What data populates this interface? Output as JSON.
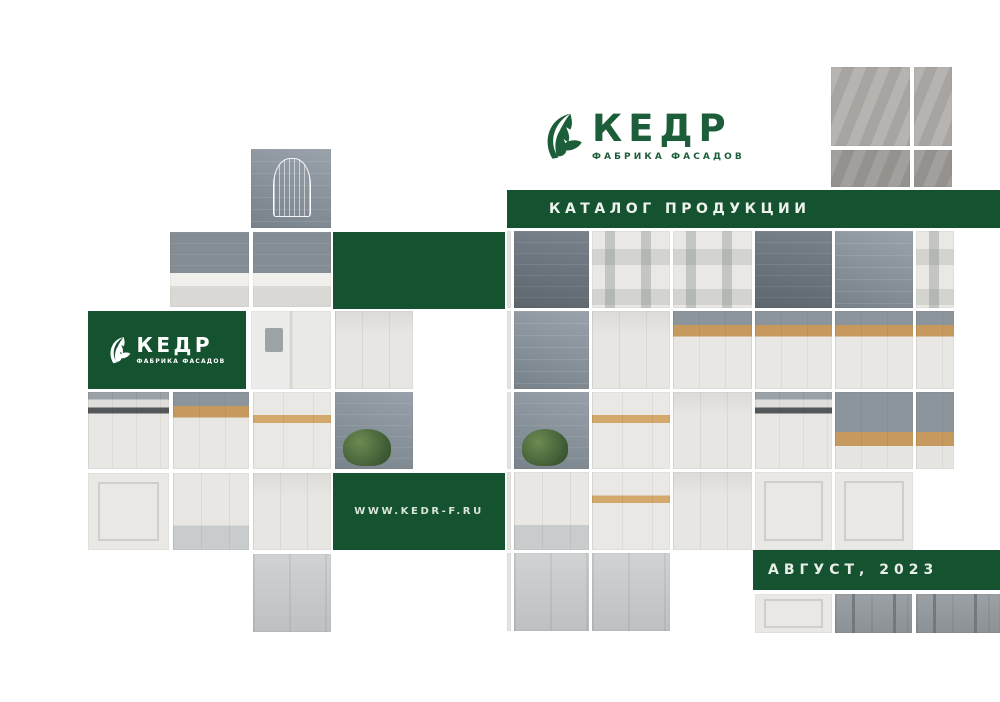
{
  "cover": {
    "brand": {
      "name": "КЕДР",
      "tagline": "ФАБРИКА ФАСАДОВ"
    },
    "title_band": {
      "label": "КАТАЛОГ ПРОДУКЦИИ"
    },
    "side_logo": {
      "name": "КЕДР",
      "tagline": "ФАБРИКА ФАСАДОВ"
    },
    "website": {
      "url": "WWW.KEDR-F.RU"
    },
    "issue": {
      "label": "АВГУСТ, 2023"
    },
    "colors": {
      "brand_green": "#15522f",
      "logo_green": "#1c5e39",
      "text_on_green": "#eef3ee"
    },
    "icons": {
      "brand_logo": "cedar-tree-icon"
    }
  }
}
